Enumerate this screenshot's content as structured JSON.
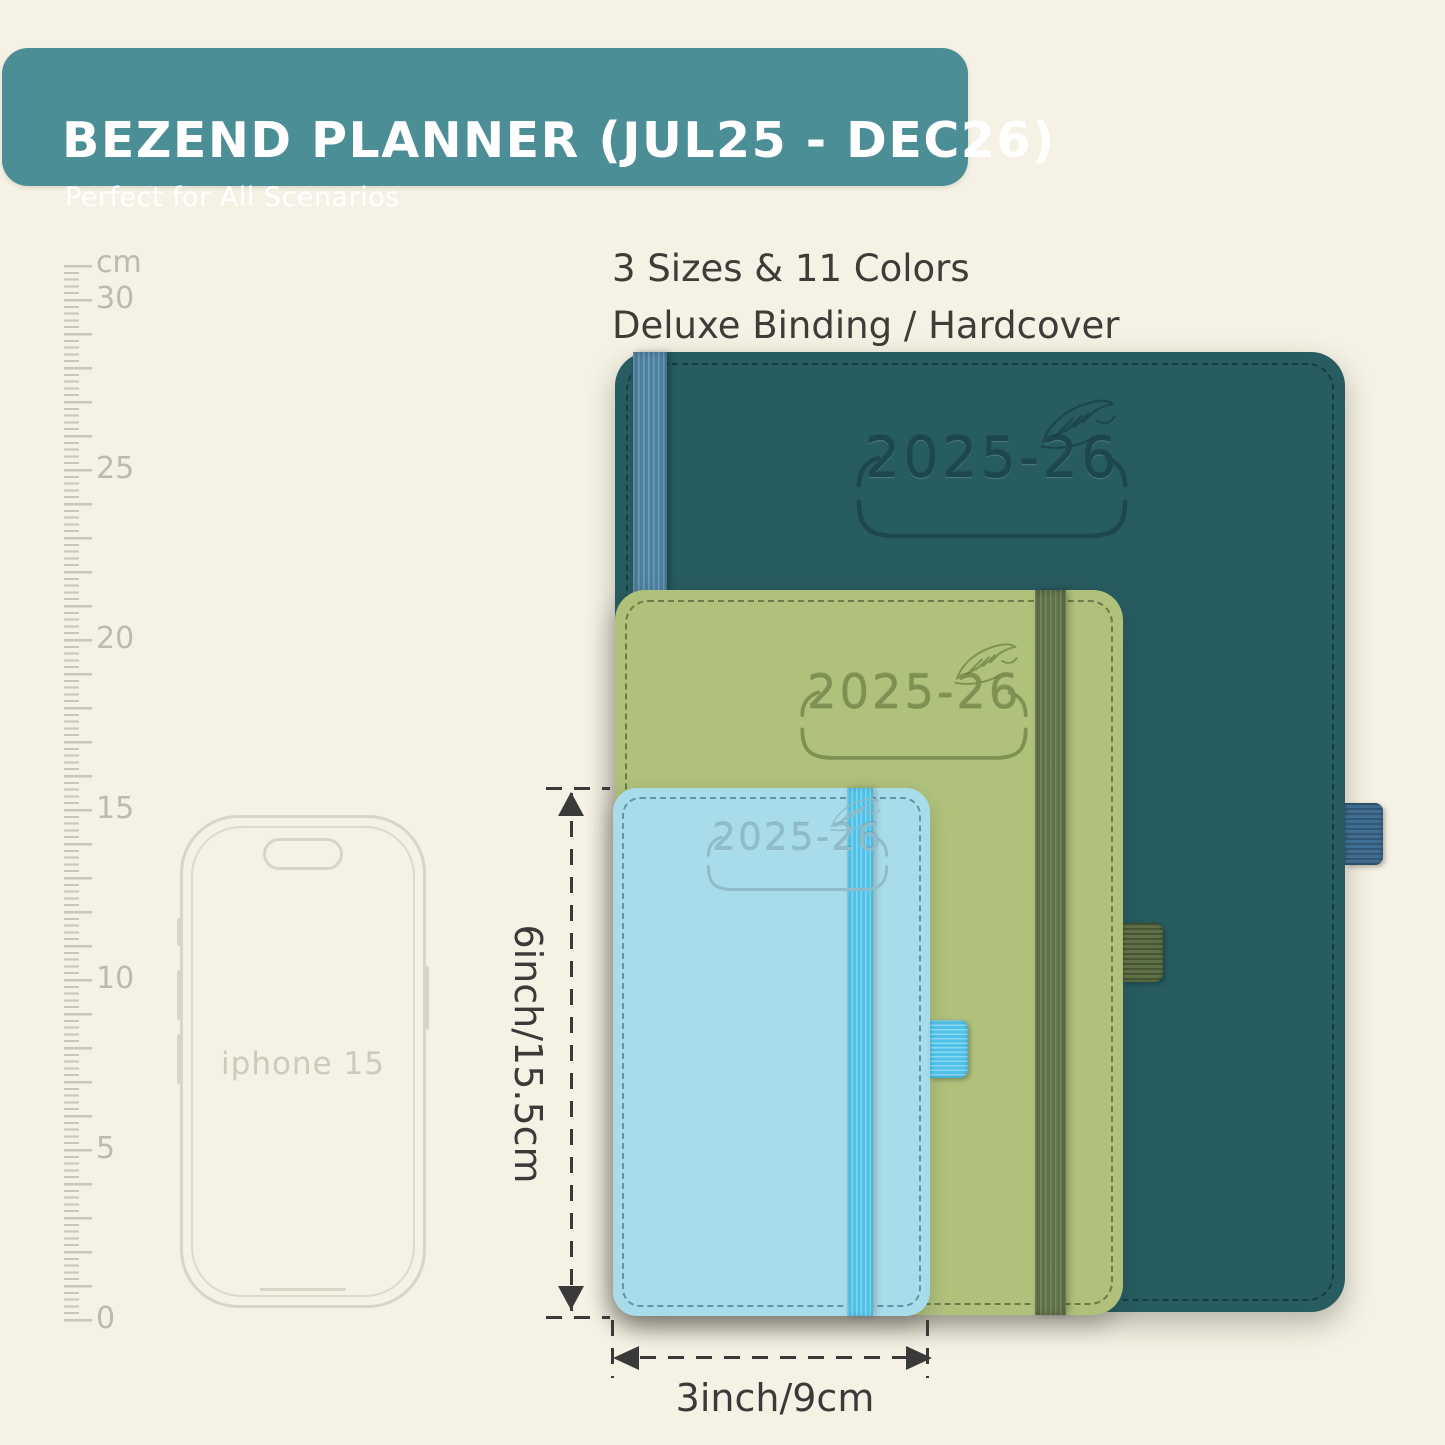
{
  "banner": {
    "title": "BEZEND PLANNER (JUL25 - DEC26)",
    "subtitle": "Perfect for All Scenarios"
  },
  "info": {
    "line1": "3 Sizes & 11 Colors",
    "line2": "Deluxe Binding / Hardcover"
  },
  "ruler": {
    "labels": [
      "cm",
      "30",
      "25",
      "20",
      "15",
      "10",
      "5",
      "0"
    ]
  },
  "phone": {
    "label": "iphone 15"
  },
  "planners": {
    "large": {
      "year_label": "2025-26",
      "cover_color": "#275C61",
      "band_color": "#4C80A1",
      "emboss_color": "#1C474C"
    },
    "medium": {
      "year_label": "2025-26",
      "cover_color": "#AFC17B",
      "band_color": "#5F7147",
      "emboss_color": "#7E9150"
    },
    "small": {
      "year_label": "2025-26",
      "cover_color": "#A8DCEA",
      "band_color": "#4FC2E9",
      "emboss_color": "#8FBBCB"
    }
  },
  "dimensions": {
    "height_label": "6inch/15.5cm",
    "width_label": "3inch/9cm"
  },
  "colors": {
    "background": "#F5F1E4",
    "banner": "#4B8E96",
    "banner_text": "#FFFFFF",
    "annotation": "#3A3A3A",
    "ruler_ticks": "#C9C5B7",
    "phone_outline": "#D8D4C6"
  }
}
